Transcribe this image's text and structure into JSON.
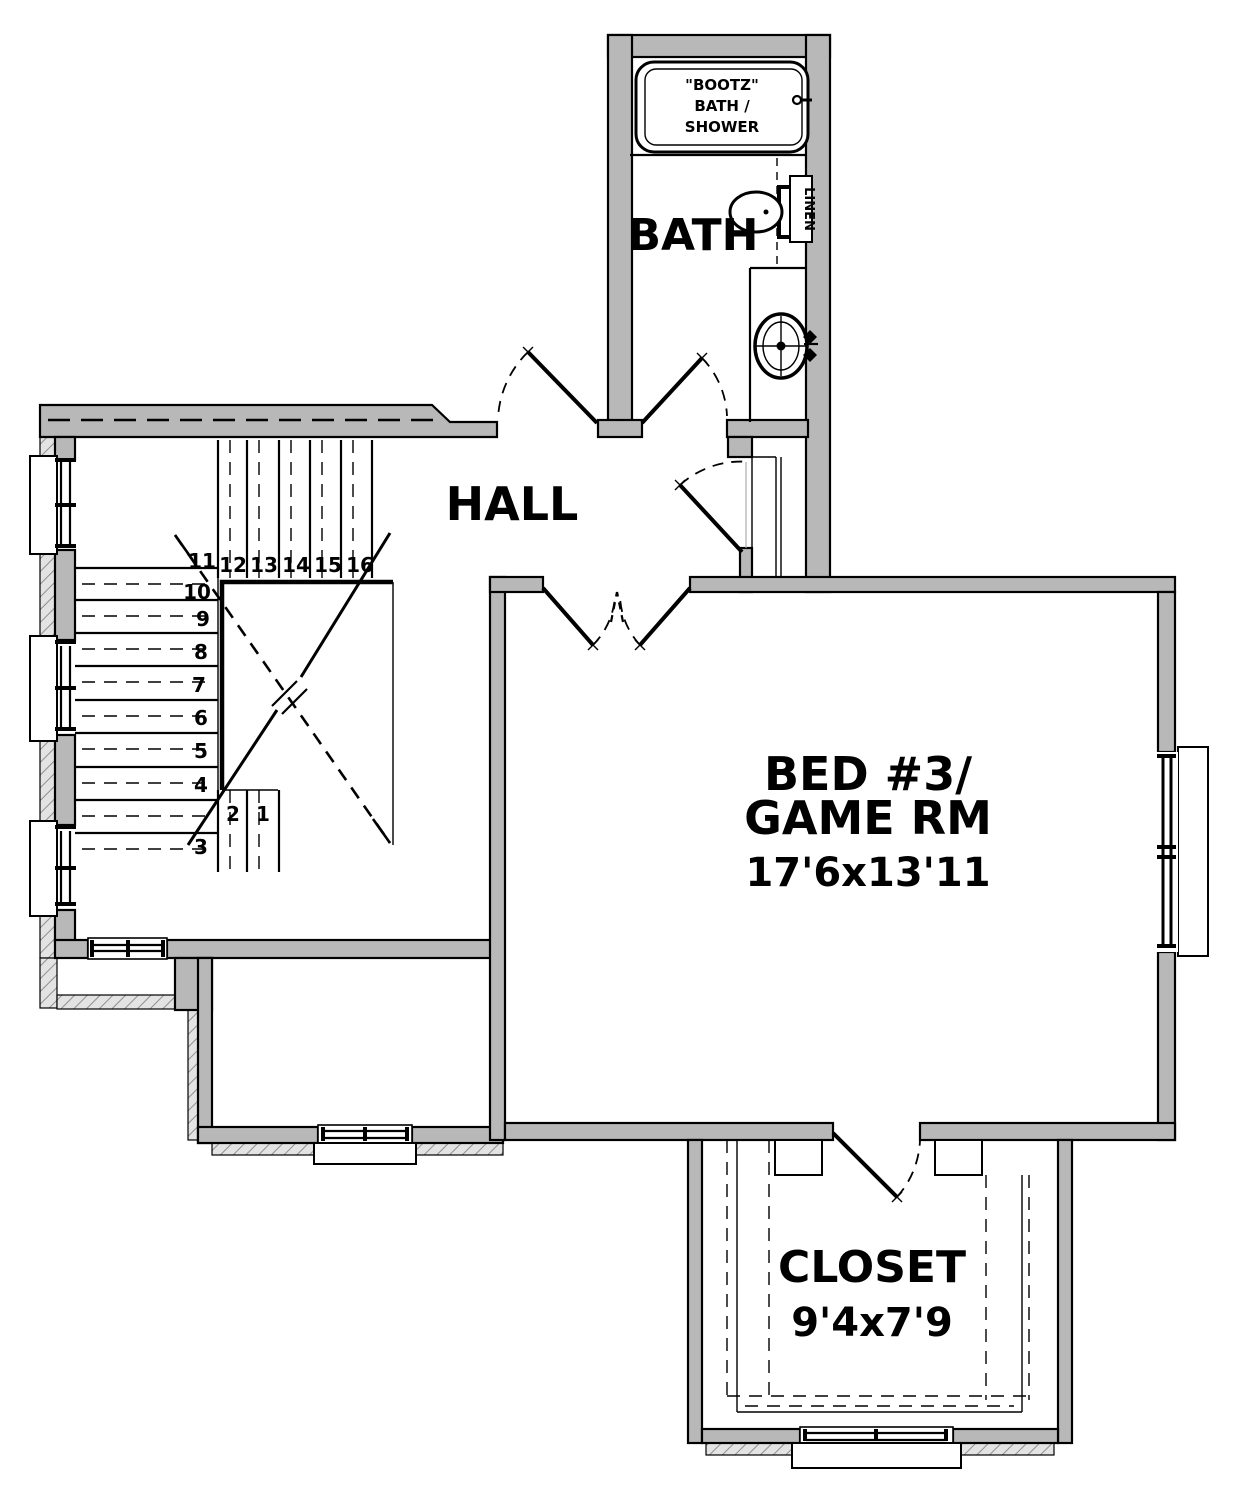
{
  "plan": {
    "rooms": {
      "bath": {
        "label": "BATH"
      },
      "hall": {
        "label": "HALL"
      },
      "bedroom": {
        "line1": "BED #3/",
        "line2": "GAME RM",
        "dims": "17'6x13'11"
      },
      "closet": {
        "label": "CLOSET",
        "dims": "9'4x7'9"
      }
    },
    "fixtures": {
      "tub": {
        "line1": "\"BOOTZ\"",
        "line2": "BATH /",
        "line3": "SHOWER"
      },
      "linen": {
        "label": "LINEN"
      }
    },
    "stairs": {
      "numbers": [
        "1",
        "2",
        "3",
        "4",
        "5",
        "6",
        "7",
        "8",
        "9",
        "10",
        "11",
        "12",
        "13",
        "14",
        "15",
        "16"
      ]
    },
    "colors": {
      "paper": "#ffffff",
      "wall_fill": "#b8b8b8",
      "hatch_bg": "#e3e3e3",
      "hatch_line": "#8f8f8f",
      "line": "#000000"
    }
  }
}
